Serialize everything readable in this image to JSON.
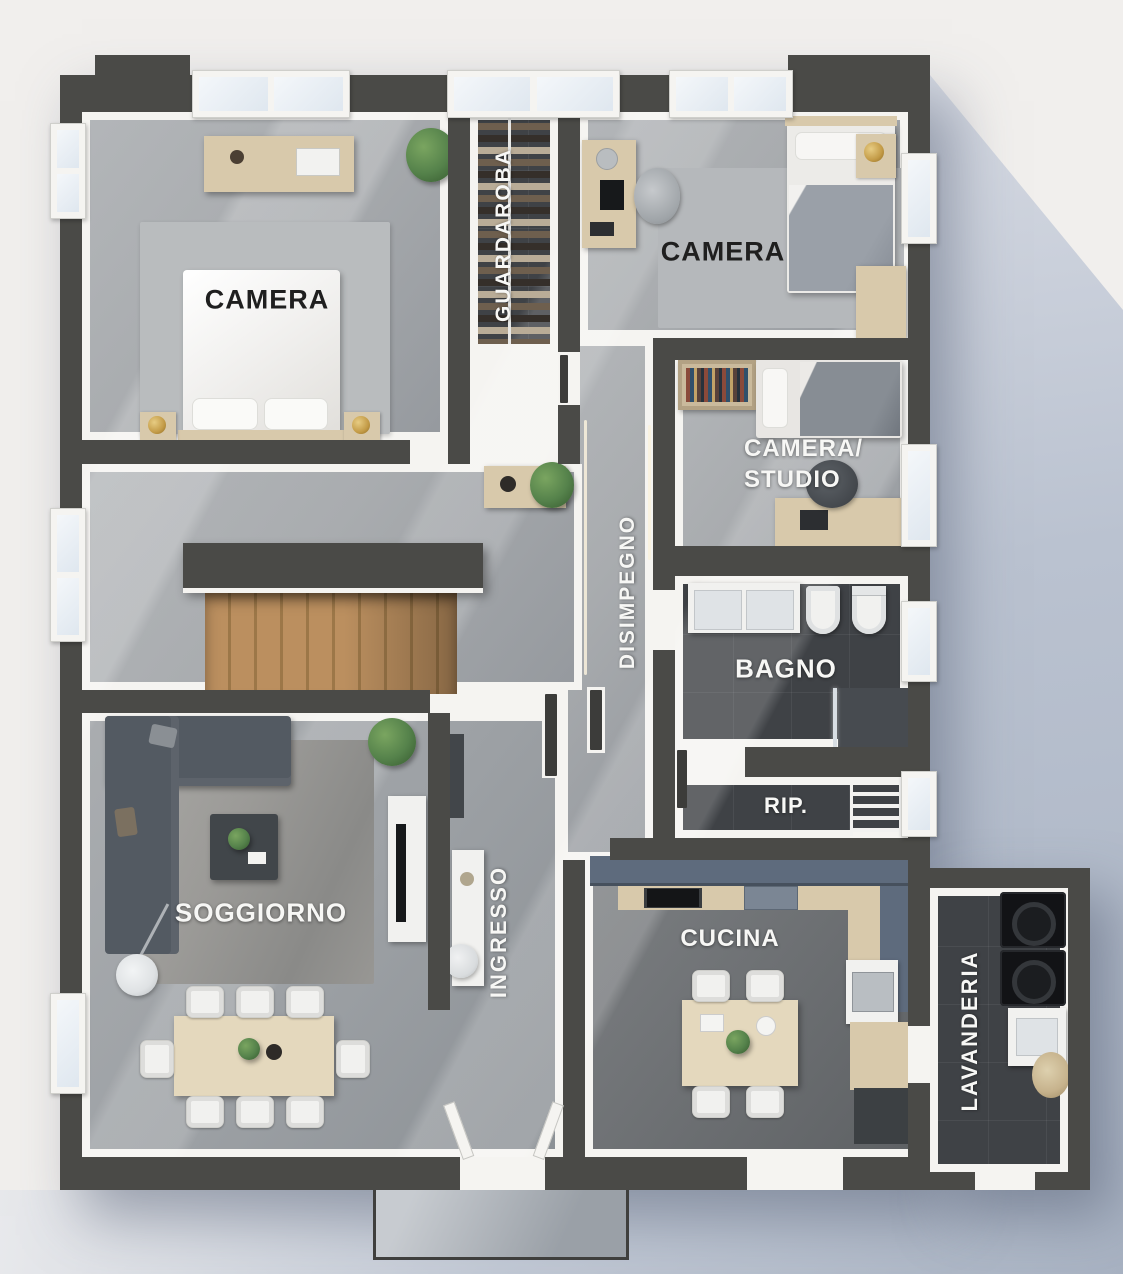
{
  "title": "Pianta appartamento - piano arredato",
  "palette": {
    "bg": "#f1efed",
    "wall": "#4a4a47",
    "trim": "#f5f4f1",
    "floor_light": "#a9acaf",
    "floor_dark": "#3f4246",
    "floor_kitchen": "#6b6e71",
    "wood_stairs": "#bb8f5f",
    "wood_furn": "#d8c9ab",
    "cabinet_blue": "#5e6b7d",
    "sofa_gray": "#535a62",
    "plant_green": "#55824b",
    "gold": "#c39b47",
    "text_dark": "#1f1f1f",
    "text_light": "#f7f7f5",
    "ground_shadow": "#a8b2c2"
  },
  "rooms": {
    "camera_left": {
      "label": "CAMERA"
    },
    "guardaroba": {
      "label": "GUARDAROBA"
    },
    "camera_right": {
      "label": "CAMERA"
    },
    "camera_studio": {
      "label": "CAMERA/STUDIO",
      "line1": "CAMERA/",
      "line2": "STUDIO"
    },
    "disimpegno": {
      "label": "DISIMPEGNO"
    },
    "bagno": {
      "label": "BAGNO"
    },
    "ripostiglio": {
      "label": "RIP."
    },
    "soggiorno": {
      "label": "SOGGIORNO"
    },
    "ingresso": {
      "label": "INGRESSO"
    },
    "cucina": {
      "label": "CUCINA"
    },
    "lavanderia": {
      "label": "LAVANDERIA"
    }
  }
}
